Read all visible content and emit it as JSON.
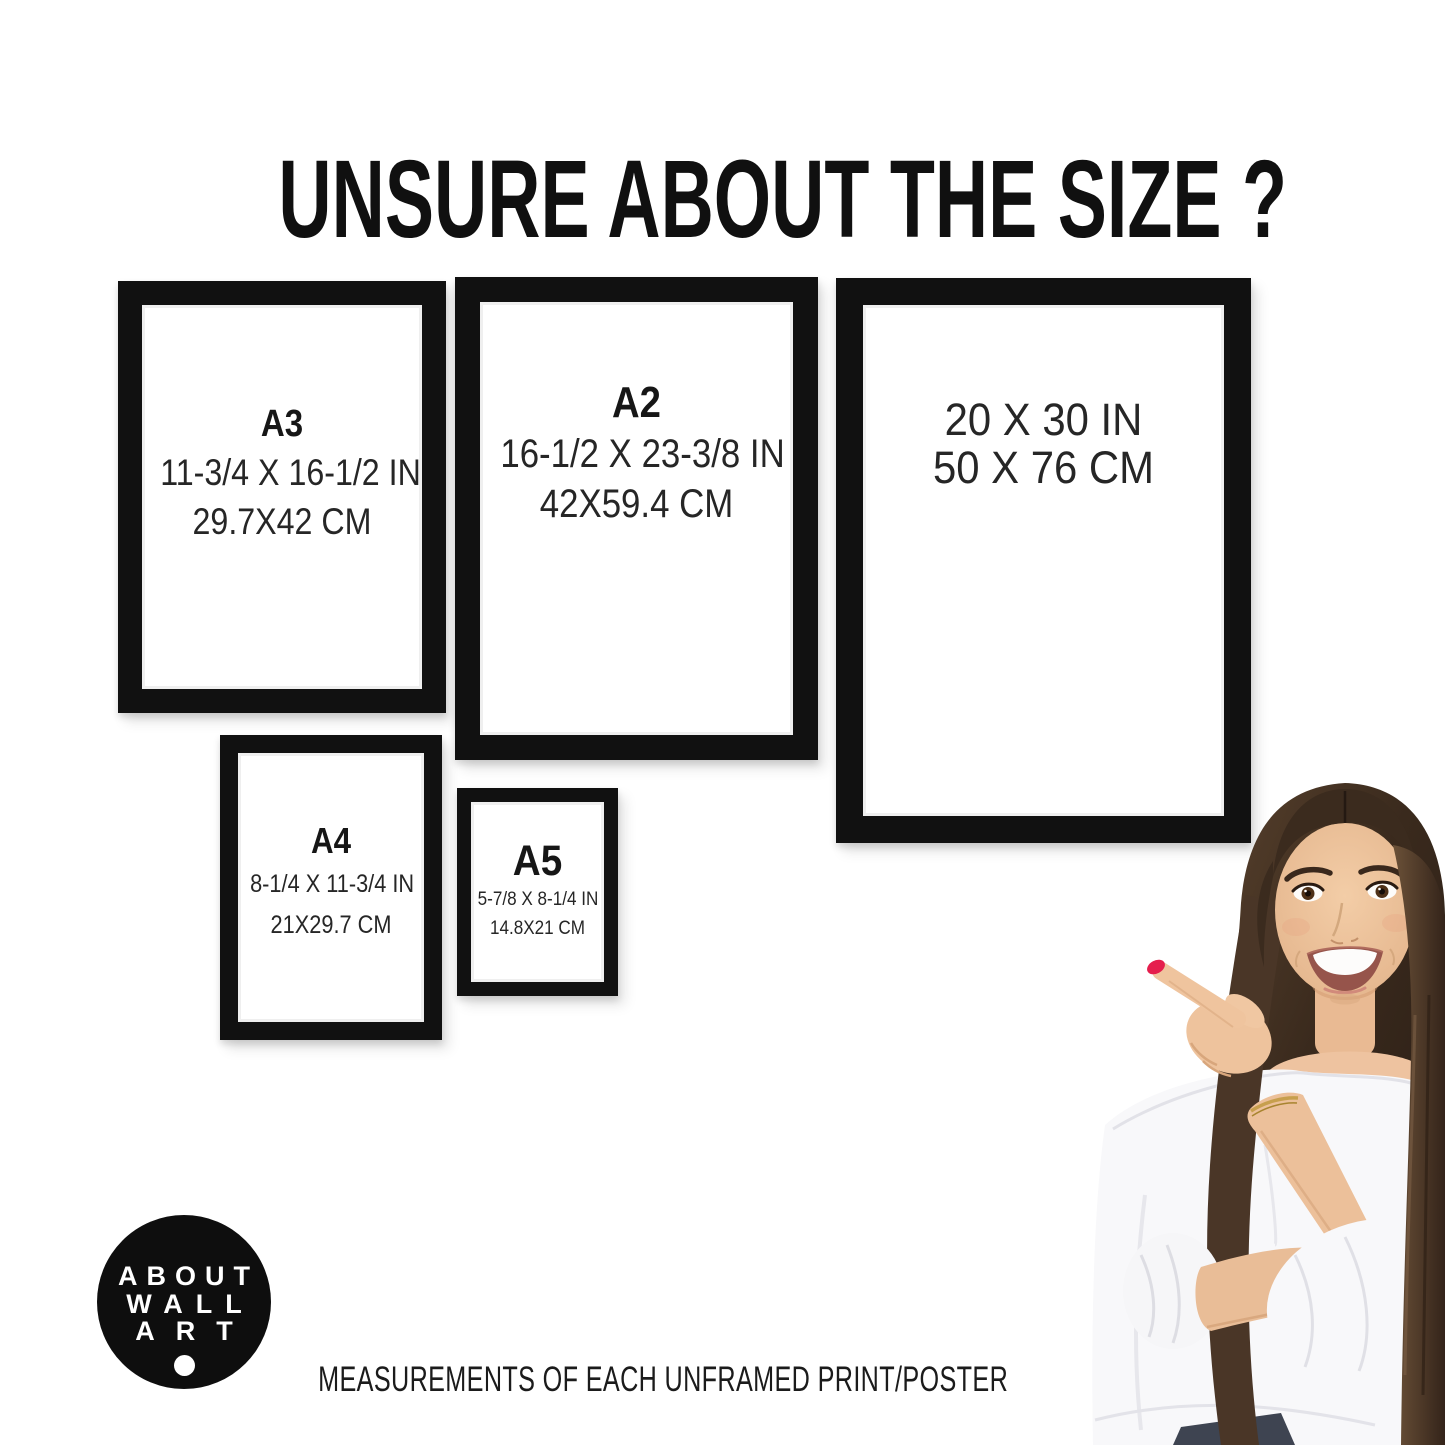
{
  "page": {
    "title": "UNSURE ABOUT THE SIZE ?",
    "caption": "MEASUREMENTS OF EACH UNFRAMED PRINT/POSTER",
    "background": "#ffffff"
  },
  "frames": [
    {
      "id": "a3",
      "label": "A3",
      "inches": "11-3/4 X 16-1/2 IN",
      "cm": "29.7X42 CM"
    },
    {
      "id": "a2",
      "label": "A2",
      "inches": "16-1/2 X 23-3/8 IN",
      "cm": "42X59.4 CM"
    },
    {
      "id": "20x30",
      "label": "",
      "inches": "20 X 30 IN",
      "cm": "50 X 76 CM"
    },
    {
      "id": "a4",
      "label": "A4",
      "inches": "8-1/4 X 11-3/4 IN",
      "cm": "21X29.7 CM"
    },
    {
      "id": "a5",
      "label": "A5",
      "inches": "5-7/8 X 8-1/4 IN",
      "cm": "14.8X21 CM"
    }
  ],
  "logo": {
    "lines": [
      "ABOUT",
      "WALL",
      "ART"
    ]
  },
  "colors": {
    "frame_black": "#111111",
    "text": "#1c1c1c",
    "logo_background": "#0e0e0e",
    "nail_red": "#e51e4d",
    "hair_brown": "#3a2a1d",
    "blouse_white": "#f8f8fa"
  }
}
